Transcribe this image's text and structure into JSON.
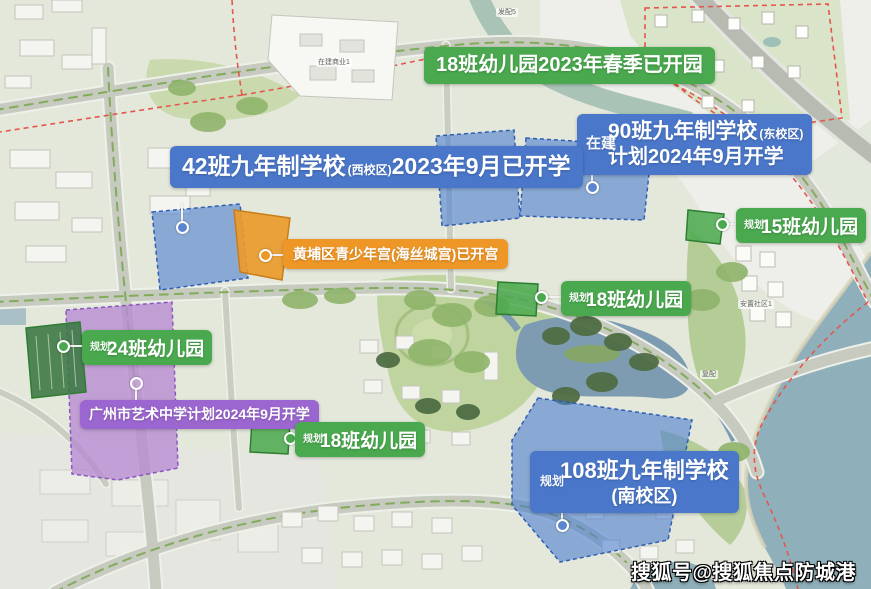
{
  "callouts": {
    "kg18_top": {
      "line1": "18班幼儿园",
      "line2": "2023年春季已开园"
    },
    "sch90": {
      "tag": "在建",
      "line1": "90班九年制学校",
      "suffix": "(东校区)",
      "line2": "计划2024年9月开学"
    },
    "sch42": {
      "line1": "42班九年制学校",
      "suffix": "(西校区)",
      "line2": "2023年9月已开学"
    },
    "kg15": {
      "tag": "规划",
      "label": "15班幼儿园"
    },
    "youth_palace": {
      "label": "黄埔区青少年宫(海丝城宫)已开宫"
    },
    "kg18_mid": {
      "tag": "规划",
      "label": "18班幼儿园"
    },
    "kg24": {
      "tag": "规划",
      "label": "24班幼儿园"
    },
    "art_school": {
      "line1": "广州市艺术中学",
      "line2": "计划2024年9月开学"
    },
    "kg18_bottom": {
      "tag": "规划",
      "label": "18班幼儿园"
    },
    "sch108": {
      "tag": "规划",
      "line1": "108班九年制学校",
      "line2": "(南校区)"
    }
  },
  "map_labels": {
    "commercial": "在建商业1",
    "plot5": "发配5",
    "fupei": "复配",
    "community": "安置社区1"
  },
  "watermark": {
    "text": "搜狐号@搜狐焦点防城港站"
  },
  "colors": {
    "green_label": "#4aa94e",
    "blue_label": "#4a77c9",
    "orange_label": "#ee9626",
    "purple_label": "#9b66cf",
    "parcel_blue": "#4d7fd0",
    "parcel_purple": "#b78ad2",
    "water": "#8fb0ba",
    "boundary_red": "#e4574d"
  }
}
